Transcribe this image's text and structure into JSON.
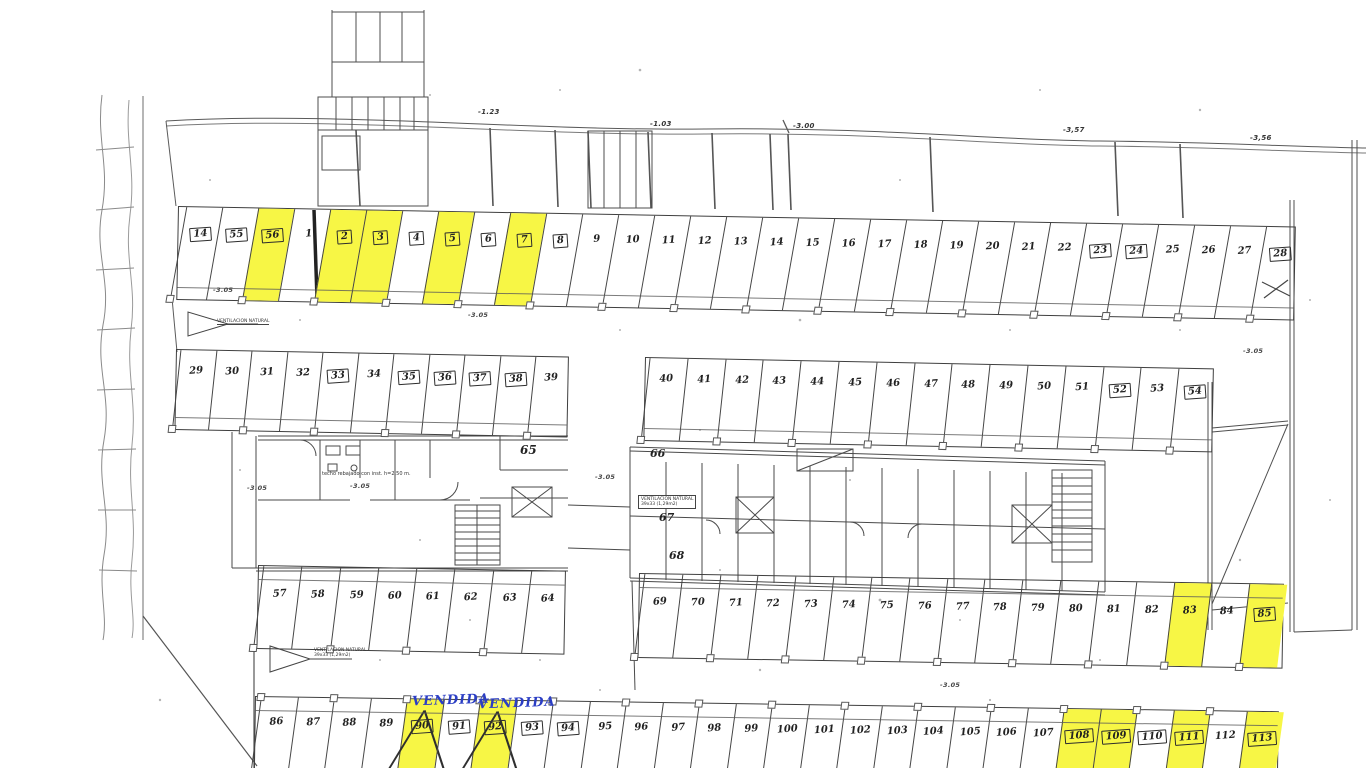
{
  "document": {
    "kind": "scanned parking garage floor plan",
    "language": "es"
  },
  "colors": {
    "highlight_yellow": "#f7f645",
    "ink": "#3f3f3f",
    "handwriting_blue": "#2b3ec4"
  },
  "annotations": {
    "elevations_top": [
      "-1.23",
      "-1.03",
      "-3.00",
      "-3,57",
      "-3,56"
    ],
    "elevations_floor": [
      "-3.05",
      "-3.05",
      "-3.05",
      "-3.05",
      "-3.05",
      "-3.05",
      "-3.05"
    ],
    "ceiling_note": "techo rebajado con inst. h=2,50 m.",
    "ventilation_label": "VENTILACION NATURAL",
    "ventilation_size": "39x33 (1,29m2)",
    "vendida": [
      "VENDIDA",
      "VENDIDA"
    ]
  },
  "rooms": {
    "r65": "65",
    "r66": "66",
    "r67": "67",
    "r68": "68"
  },
  "rows": {
    "row1": [
      {
        "n": "14",
        "boxed": true
      },
      {
        "n": "55",
        "boxed": true
      },
      {
        "n": "56",
        "boxed": true,
        "yellow": true
      },
      {
        "n": "1"
      },
      {
        "n": "2",
        "boxed": true,
        "yellow": true
      },
      {
        "n": "3",
        "boxed": true,
        "yellow": true
      },
      {
        "n": "4",
        "boxed": true
      },
      {
        "n": "5",
        "boxed": true,
        "yellow": true
      },
      {
        "n": "6",
        "boxed": true
      },
      {
        "n": "7",
        "boxed": true,
        "yellow": true
      },
      {
        "n": "8",
        "boxed": true
      },
      {
        "n": "9"
      },
      {
        "n": "10"
      },
      {
        "n": "11"
      },
      {
        "n": "12"
      },
      {
        "n": "13"
      },
      {
        "n": "14"
      },
      {
        "n": "15"
      },
      {
        "n": "16"
      },
      {
        "n": "17"
      },
      {
        "n": "18"
      },
      {
        "n": "19"
      },
      {
        "n": "20"
      },
      {
        "n": "21"
      },
      {
        "n": "22"
      },
      {
        "n": "23",
        "boxed": true
      },
      {
        "n": "24",
        "boxed": true
      },
      {
        "n": "25"
      },
      {
        "n": "26"
      },
      {
        "n": "27"
      },
      {
        "n": "28",
        "boxed": true
      }
    ],
    "row2_left": [
      {
        "n": "29"
      },
      {
        "n": "30"
      },
      {
        "n": "31"
      },
      {
        "n": "32"
      },
      {
        "n": "33",
        "boxed": true
      },
      {
        "n": "34"
      },
      {
        "n": "35",
        "boxed": true
      },
      {
        "n": "36",
        "boxed": true
      },
      {
        "n": "37",
        "boxed": true
      },
      {
        "n": "38",
        "boxed": true
      },
      {
        "n": "39"
      }
    ],
    "row2_right": [
      {
        "n": "40"
      },
      {
        "n": "41"
      },
      {
        "n": "42"
      },
      {
        "n": "43"
      },
      {
        "n": "44"
      },
      {
        "n": "45"
      },
      {
        "n": "46"
      },
      {
        "n": "47"
      },
      {
        "n": "48"
      },
      {
        "n": "49"
      },
      {
        "n": "50"
      },
      {
        "n": "51"
      },
      {
        "n": "52",
        "boxed": true
      },
      {
        "n": "53"
      },
      {
        "n": "54",
        "boxed": true
      }
    ],
    "row3_left": [
      {
        "n": "57"
      },
      {
        "n": "58"
      },
      {
        "n": "59"
      },
      {
        "n": "60"
      },
      {
        "n": "61"
      },
      {
        "n": "62"
      },
      {
        "n": "63"
      },
      {
        "n": "64"
      }
    ],
    "row3_right": [
      {
        "n": "69"
      },
      {
        "n": "70"
      },
      {
        "n": "71"
      },
      {
        "n": "72"
      },
      {
        "n": "73"
      },
      {
        "n": "74"
      },
      {
        "n": "75"
      },
      {
        "n": "76"
      },
      {
        "n": "77"
      },
      {
        "n": "78"
      },
      {
        "n": "79"
      },
      {
        "n": "80"
      },
      {
        "n": "81"
      },
      {
        "n": "82"
      },
      {
        "n": "83",
        "yellow": true
      },
      {
        "n": "84"
      },
      {
        "n": "85",
        "boxed": true,
        "yellow": true
      }
    ],
    "row4": [
      {
        "n": "86"
      },
      {
        "n": "87"
      },
      {
        "n": "88"
      },
      {
        "n": "89"
      },
      {
        "n": "90",
        "boxed": true,
        "yellow": true,
        "sold": true
      },
      {
        "n": "91",
        "boxed": true
      },
      {
        "n": "92",
        "boxed": true,
        "yellow": true,
        "sold": true
      },
      {
        "n": "93",
        "boxed": true
      },
      {
        "n": "94",
        "boxed": true
      },
      {
        "n": "95"
      },
      {
        "n": "96"
      },
      {
        "n": "97"
      },
      {
        "n": "98"
      },
      {
        "n": "99"
      },
      {
        "n": "100"
      },
      {
        "n": "101"
      },
      {
        "n": "102"
      },
      {
        "n": "103"
      },
      {
        "n": "104"
      },
      {
        "n": "105"
      },
      {
        "n": "106"
      },
      {
        "n": "107"
      },
      {
        "n": "108",
        "boxed": true,
        "yellow": true
      },
      {
        "n": "109",
        "boxed": true,
        "yellow": true
      },
      {
        "n": "110",
        "boxed": true
      },
      {
        "n": "111",
        "boxed": true,
        "yellow": true
      },
      {
        "n": "112"
      },
      {
        "n": "113",
        "boxed": true,
        "yellow": true
      }
    ]
  }
}
